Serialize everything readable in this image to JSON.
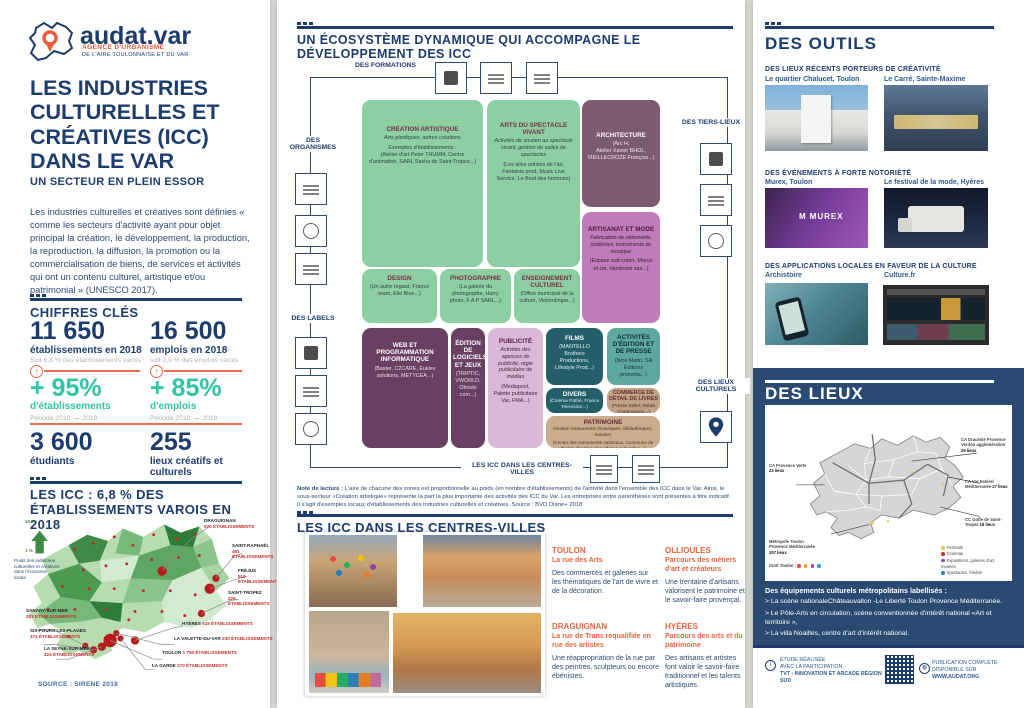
{
  "colors": {
    "navy": "#1d3c6e",
    "orange": "#f05a3c",
    "teal": "#2fc5a4",
    "panel_navy": "#2b4a72",
    "map_red": "#c22f2a"
  },
  "left": {
    "logo": {
      "brand": "audat.var",
      "tagline1": "AGENCE D'URBANISME",
      "tagline2": "DE L'AIRE TOULONNAISE ET DU VAR"
    },
    "title": "LES INDUSTRIES CULTURELLES ET CRÉATIVES (ICC) DANS LE VAR",
    "subtitle": "UN SECTEUR EN PLEIN ESSOR",
    "intro": "Les industries culturelles et créatives sont définies « comme les secteurs d'activité ayant pour objet principal la création, le développement, la production, la reproduction, la diffusion, la promotion ou la commercialisation de biens, de services et activités qui ont un contenu culturel, artistique et/ou patrimonial » (UNESCO 2017).",
    "chiffres": {
      "header": "CHIFFRES CLÉS",
      "etabs": {
        "value": "11 650",
        "label": "établissements en 2018",
        "sub": "Soit 6,8 % des établissements varois"
      },
      "emplois": {
        "value": "16 500",
        "label": "emplois en 2018",
        "sub": "soit 3,9 % des emplois varois"
      },
      "growth_etabs": {
        "value": "+ 95%",
        "label": "d'établissements",
        "period_from": "Période 2010",
        "arrow": "→",
        "period_to": "2018"
      },
      "growth_emplois": {
        "value": "+ 85%",
        "label": "d'emplois",
        "period_from": "Période 2010",
        "arrow": "→",
        "period_to": "2018"
      },
      "etudiants": {
        "value": "3 600",
        "label": "étudiants"
      },
      "lieux": {
        "value": "255",
        "label": "lieux créatifs et culturels"
      }
    },
    "icc_map": {
      "header": "LES ICC : 6,8 % DES ÉTABLISSEMENTS VAROIS EN 2018",
      "legend_top": "10 %",
      "legend_bottom": "1 %",
      "legend_caption": "Poids des industries culturelles et créatives dans l'économie locale",
      "labels": [
        {
          "name": "DRAGUIGNAN",
          "value": "570 ÉTABLISSEMENTS"
        },
        {
          "name": "SAINT-RAPHAËL",
          "value": "451 ÉTABLISSEMENTS"
        },
        {
          "name": "FRÉJUS",
          "value": "510 ÉTABLISSEMENTS"
        },
        {
          "name": "SAINT-TROPEZ",
          "value": "226 ÉTABLISSEMENTS"
        },
        {
          "name": "HYÈRES",
          "value": "515 ÉTABLISSEMENTS"
        },
        {
          "name": "LA VALETTE-DU-VAR",
          "value": "230 ÉTABLISSEMENTS"
        },
        {
          "name": "TOULON",
          "value": "1 750 ÉTABLISSEMENTS"
        },
        {
          "name": "LA GARDE",
          "value": "270 ÉTABLISSEMENTS"
        },
        {
          "name": "SANARY-SUR-MER",
          "value": "283 ÉTABLISSEMENTS"
        },
        {
          "name": "SIX-FOURS-LES-PLAGES",
          "value": "371 ÉTABLISSEMENTS"
        },
        {
          "name": "LA SEYNE-SUR-MER",
          "value": "424 ÉTABLISSEMENTS"
        }
      ],
      "source": "SOURCE : SIRENE 2018"
    }
  },
  "center": {
    "ecosystem": {
      "header": "UN ÉCOSYSTÈME DYNAMIQUE QUI ACCOMPAGNE LE DÉVELOPPEMENT DES ICC",
      "groups": {
        "formations": "DES FORMATIONS",
        "organismes": "DES ORGANISMES",
        "labels": "DES LABELS",
        "tiers_lieux": "DES TIERS-LIEUX",
        "lieux_culturels": "DES LIEUX CULTURELS",
        "centres_villes": "LES ICC DANS LES CENTRES-VILLES"
      },
      "boxes": [
        {
          "title": "CRÉATION ARTISTIQUE",
          "desc": "Arts plastiques, autres créations",
          "body": "Exemples d'établissements :\n(Atelier d'art Peter THUMM, Centre d'animation, SARL Sasha de Saint-Tropez...)"
        },
        {
          "title": "ARTS DU SPECTACLE VIVANT",
          "desc": "Activités de soutien au spectacle vivant, gestion de salles de spectacles",
          "body": "(Les ailes artistes de l'air, Fantaisie prod, Music Live Service, Le Bruit des hommes)"
        },
        {
          "title": "ARCHITECTURE",
          "desc": "",
          "body": "(Arc H,\nAtelier Xavier BHOL,\nVIEILLECROZE François...)"
        },
        {
          "title": "ARTISANAT ET MODE",
          "desc": "Fabrication de vêtements, joailleries, instruments de musique",
          "body": "(Espace sud coton, Marca et cie, Vandoren sas...)"
        },
        {
          "title": "DESIGN",
          "desc": "",
          "body": "(Un autre regard, France team, Elio Blue...)"
        },
        {
          "title": "PHOTOGRAPHIE",
          "desc": "",
          "body": "(La galerie du photographe, Harry photo, F A P SARL...)"
        },
        {
          "title": "ENSEIGNEMENT CULTUREL",
          "desc": "",
          "body": "(Office municipal de la culture, Violondingre...)"
        },
        {
          "title": "WEB ET PROGRAMMATION INFORMATIQUE",
          "desc": "",
          "body": "(Baxter, C2CARE, Eukles solutions, METYCEA...)"
        },
        {
          "title": "ÉDITION DE LOGICIELS ET JEUX",
          "desc": "",
          "body": "(TRIPTIC, VWORLD, Oboulo com...)"
        },
        {
          "title": "PUBLICITÉ",
          "desc": "Activités des agences de publicité, régie publicitaire de médias",
          "body": "(Mediapost, Palette publicitaire Var, FMA...)"
        },
        {
          "title": "FILMS",
          "desc": "",
          "body": "(MANTELLO Brothers Productions, Lifestyle Prod...)"
        },
        {
          "title": "ACTIVITÉS D'ÉDITION ET DE PRESSE",
          "desc": "",
          "body": "(Nice Matin, SA Éditions prosveta...)"
        },
        {
          "title": "DIVERS",
          "desc": "",
          "body": "(Cinéma Pathé, France Television...)"
        },
        {
          "title": "COMMERCE DE DÉTAIL DE LIVRES",
          "desc": "",
          "body": "(Presse Zeller, Relais Charlemagne...)"
        },
        {
          "title": "PATRIMOINE",
          "desc": "Gestion monuments historiques, bibliothèques, musées",
          "body": "(Centre des monuments nationaux, Commune de Toulon direction des affaires culturelles...)"
        }
      ],
      "note_label": "Note de lecture :",
      "note": " L'aire de chacune des zones est proportionnelle au poids (en nombre d'établissements) de l'activité dans l'ensemble des ICC dans le Var. Ainsi, le sous-secteur «Création artistique» représente la part la plus importante des activités des ICC du Var. Les entreprises entre parenthèses sont présentes à titre indicatif. Il s'agit d'exemples locaux d'établissements des industries culturelles et créatives. Source : BVD Diane+ 2018"
    },
    "centres_villes": {
      "header": "LES ICC DANS LES CENTRES-VILLES",
      "cities": [
        {
          "name": "TOULON",
          "sub": "La rue des Arts",
          "body": "Des commerces et galeries sur les thématiques de l'art de vivre et de la décoration."
        },
        {
          "name": "OLLIOULES",
          "sub": "Parcours des métiers d'art et créateurs",
          "body": "Une trentaine d'artisans valorisent le patrimoine et le savoir-faire provençal."
        },
        {
          "name": "DRAGUIGNAN",
          "sub": "La rue de Trans requalifiée en rue des artistes",
          "body": "Une réappropriation de la rue par des peintres, sculpteurs ou encore ébénistes."
        },
        {
          "name": "HYÈRES",
          "sub": "Parcours des arts et du patrimoine",
          "body": "Des artisans et artistes font valoir le savoir-faire traditionnel et les talents artistiques."
        }
      ]
    }
  },
  "right": {
    "outils": {
      "header": "DES OUTILS",
      "murex_logo": "MUREX",
      "sections": [
        {
          "label": "DES LIEUX RÉCENTS PORTEURS DE CRÉATIVITÉ",
          "items": [
            {
              "name": "Le quartier Chalucet, Toulon"
            },
            {
              "name": "Le Carré, Sainte-Maxime"
            }
          ]
        },
        {
          "label": "DES ÉVÉNEMENTS À FORTE NOTORIÉTÉ",
          "items": [
            {
              "name": "Murex, Toulon"
            },
            {
              "name": "Le festival de la mode, Hyères"
            }
          ]
        },
        {
          "label": "DES APPLICATIONS LOCALES EN FAVEUR DE LA CULTURE",
          "items": [
            {
              "name": "Archistoire"
            },
            {
              "name": "Culture.fr"
            }
          ]
        }
      ]
    },
    "lieux": {
      "header": "DES LIEUX",
      "map_labels": [
        {
          "name": "CA Dracénie Provence Verdon agglomération",
          "value": "29 lieux"
        },
        {
          "name": "CA Provence Verte",
          "value": "23 lieux"
        },
        {
          "name": "CA Var Estérel Méditerranée",
          "value": "27 lieux"
        },
        {
          "name": "CC Golfe de Saint-Tropez",
          "value": "18 lieux"
        },
        {
          "name": "Métropole Toulon Provence Méditerranée",
          "value": "107 lieux"
        },
        {
          "name": "Dont Toulon :",
          "value": ""
        }
      ],
      "legend": [
        "Festivals",
        "Cinémas",
        "Expositions, galeries d'art, musées",
        "Spectacles, théâtre"
      ],
      "equipements_heading": "Des équipements culturels métropolitains labellisés :",
      "equipements": [
        "> La scène nationaleChâteauvallon -Le Liberté Toulon Provence Méditerranée.",
        "> Le Pôle-Arts en circulation, scène conventionnée d'intérêt national «Art et territoire »,",
        "> La villa Noailles, centre d'art d'intérêt national."
      ]
    },
    "footer": {
      "left1": "ÉTUDE RÉALISÉE",
      "left2": "AVEC LA PARTICIPATION",
      "left3": "TVT - INNOVATION ET ARCADE RÉGION SUD",
      "right1": "PUBLICATION COMPLÈTE",
      "right2": "DISPONIBLE SUR",
      "right3": "WWW.AUDAT.ORG"
    }
  }
}
